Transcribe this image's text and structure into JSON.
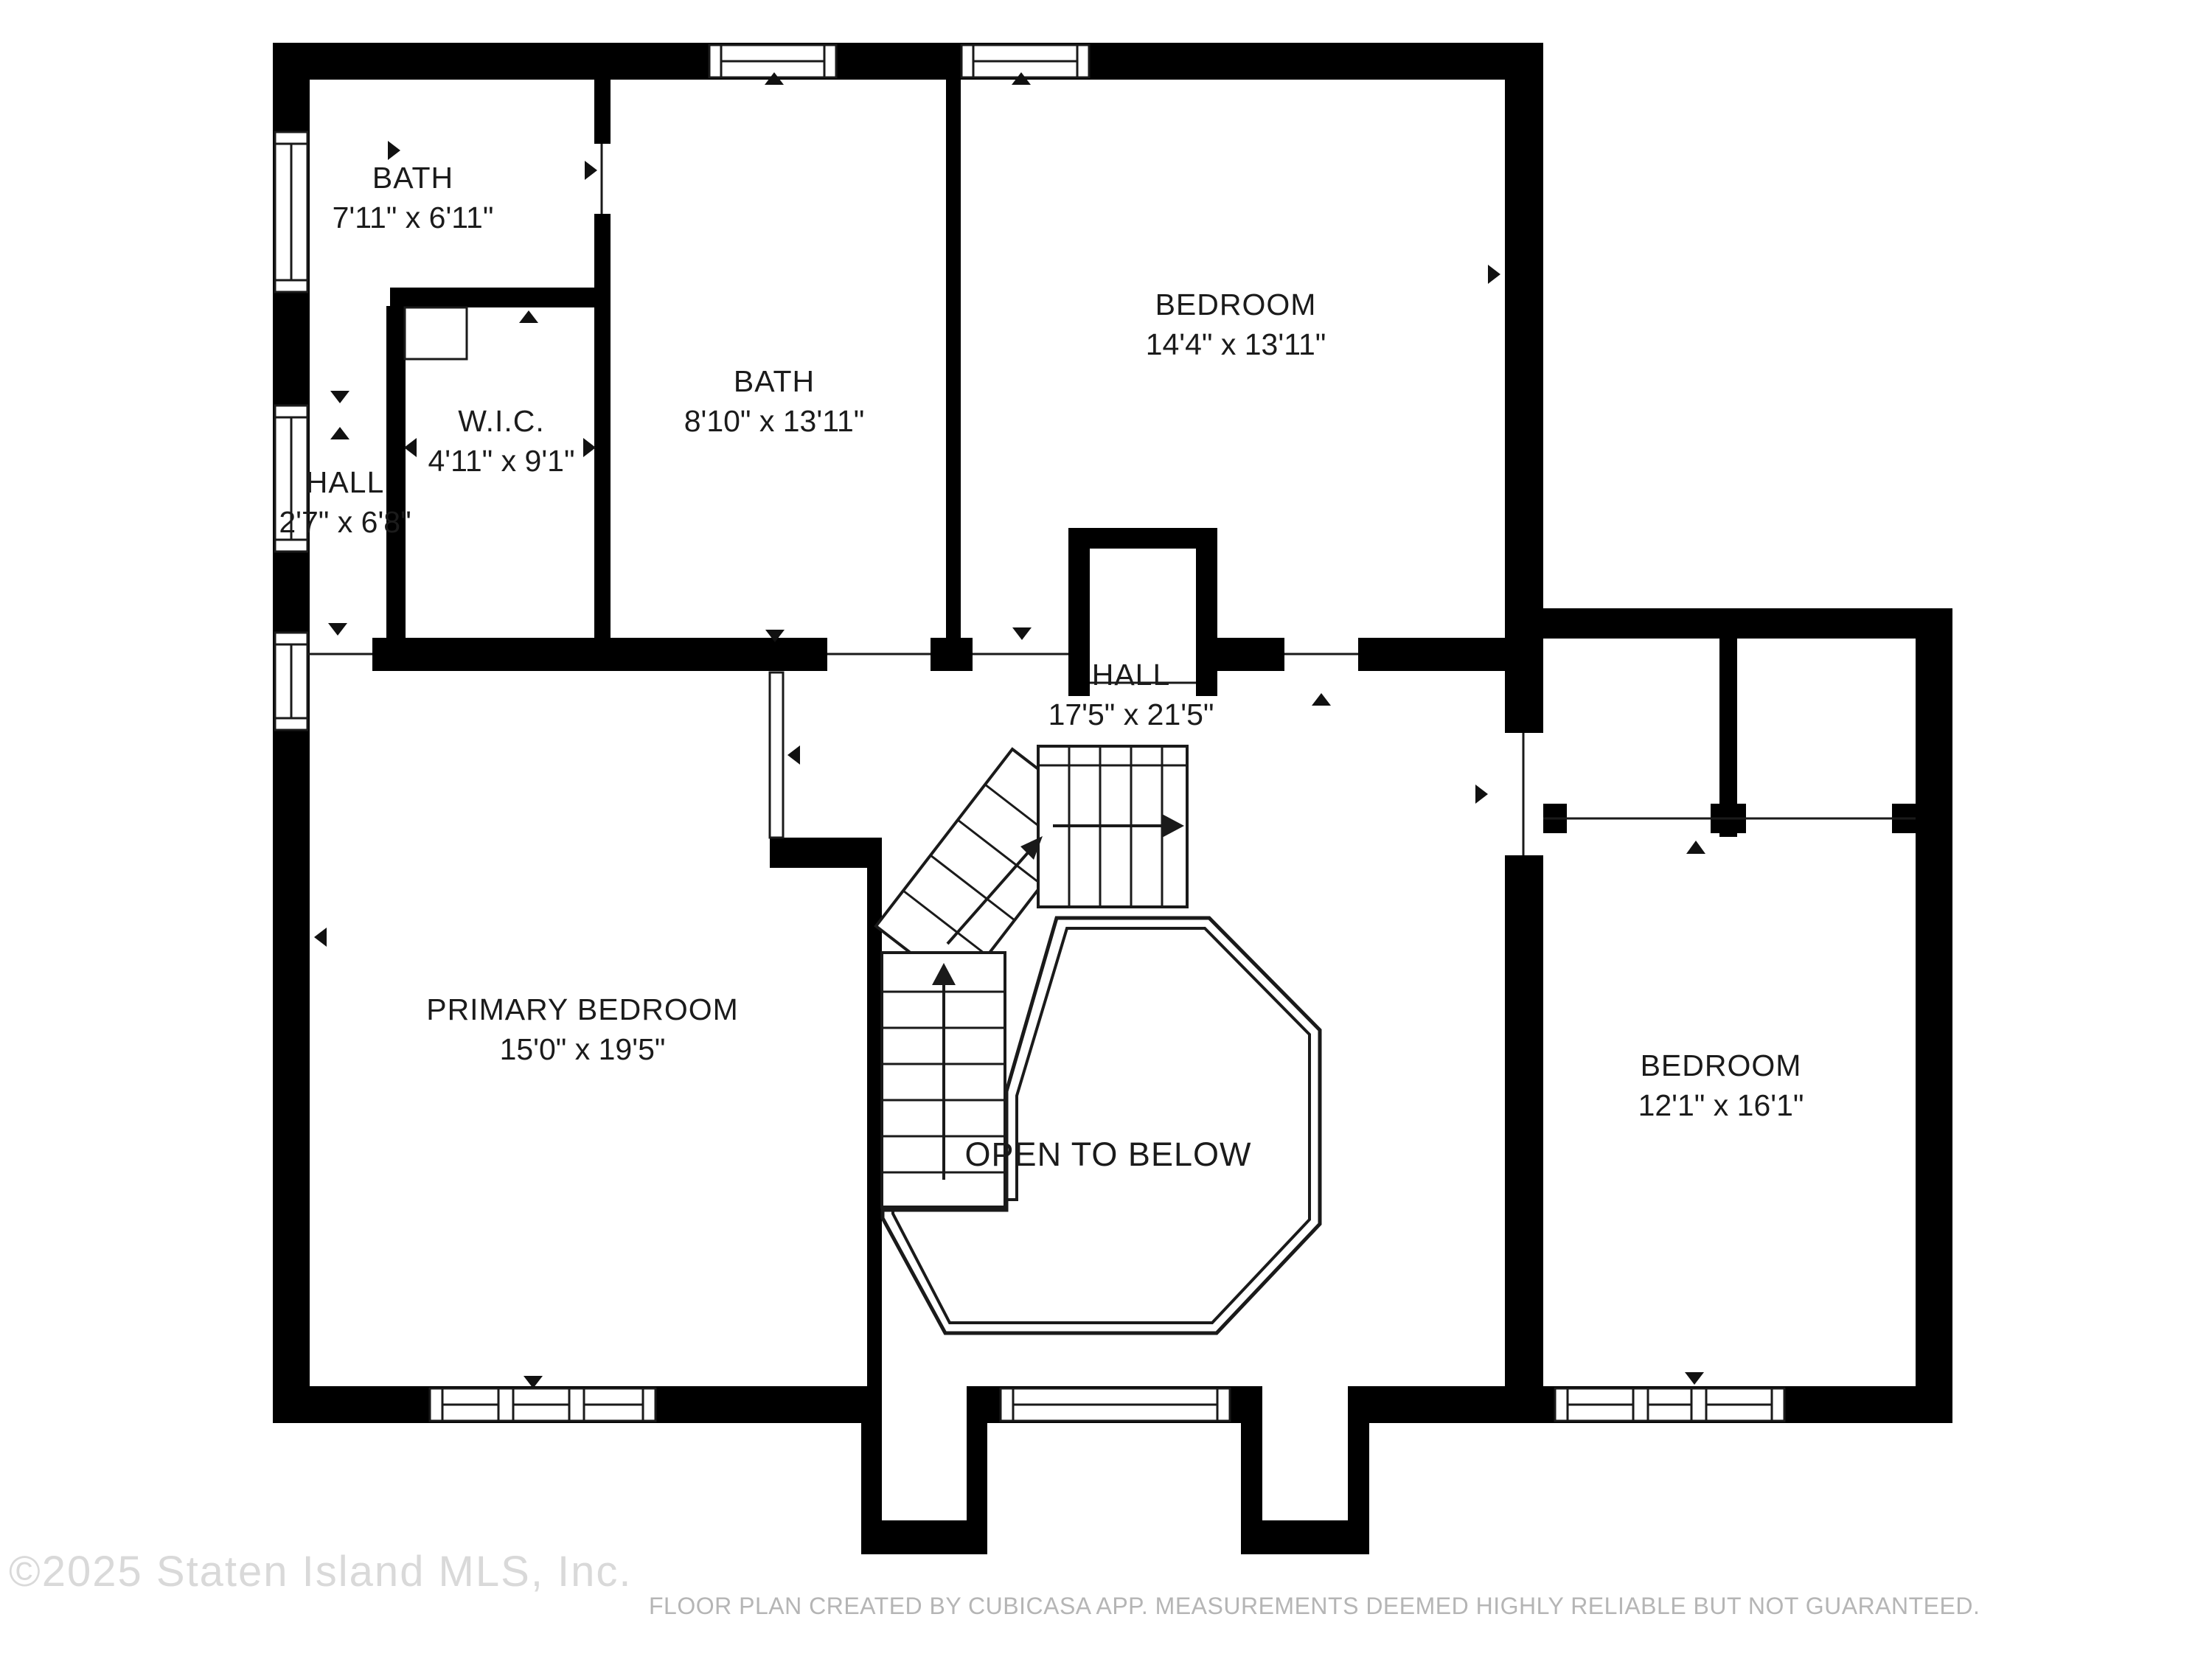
{
  "rooms": {
    "bath_small": {
      "name": "BATH",
      "dims": "7'11\" x 6'11\""
    },
    "wic": {
      "name": "W.I.C.",
      "dims": "4'11\" x 9'1\""
    },
    "hall_small": {
      "name": "HALL",
      "dims": "2'7\" x 6'8\""
    },
    "bath_main": {
      "name": "BATH",
      "dims": "8'10\" x 13'11\""
    },
    "bedroom_top": {
      "name": "BEDROOM",
      "dims": "14'4\" x 13'11\""
    },
    "hall_main": {
      "name": "HALL",
      "dims": "17'5\" x 21'5\""
    },
    "primary": {
      "name": "PRIMARY BEDROOM",
      "dims": "15'0\" x 19'5\""
    },
    "bedroom_right": {
      "name": "BEDROOM",
      "dims": "12'1\" x 16'1\""
    }
  },
  "annotations": {
    "open_to_below": "OPEN TO BELOW"
  },
  "footer": {
    "copyright": "©2025 Staten Island MLS, Inc.",
    "disclaimer": "FLOOR PLAN CREATED BY CUBICASA APP. MEASUREMENTS DEEMED HIGHLY RELIABLE BUT NOT GUARANTEED."
  },
  "colors": {
    "wall": "#000000",
    "background": "#ffffff",
    "line": "#1a1a1a",
    "copyright_text": "#d9d9d9",
    "disclaimer_text": "#b5b5b5"
  }
}
